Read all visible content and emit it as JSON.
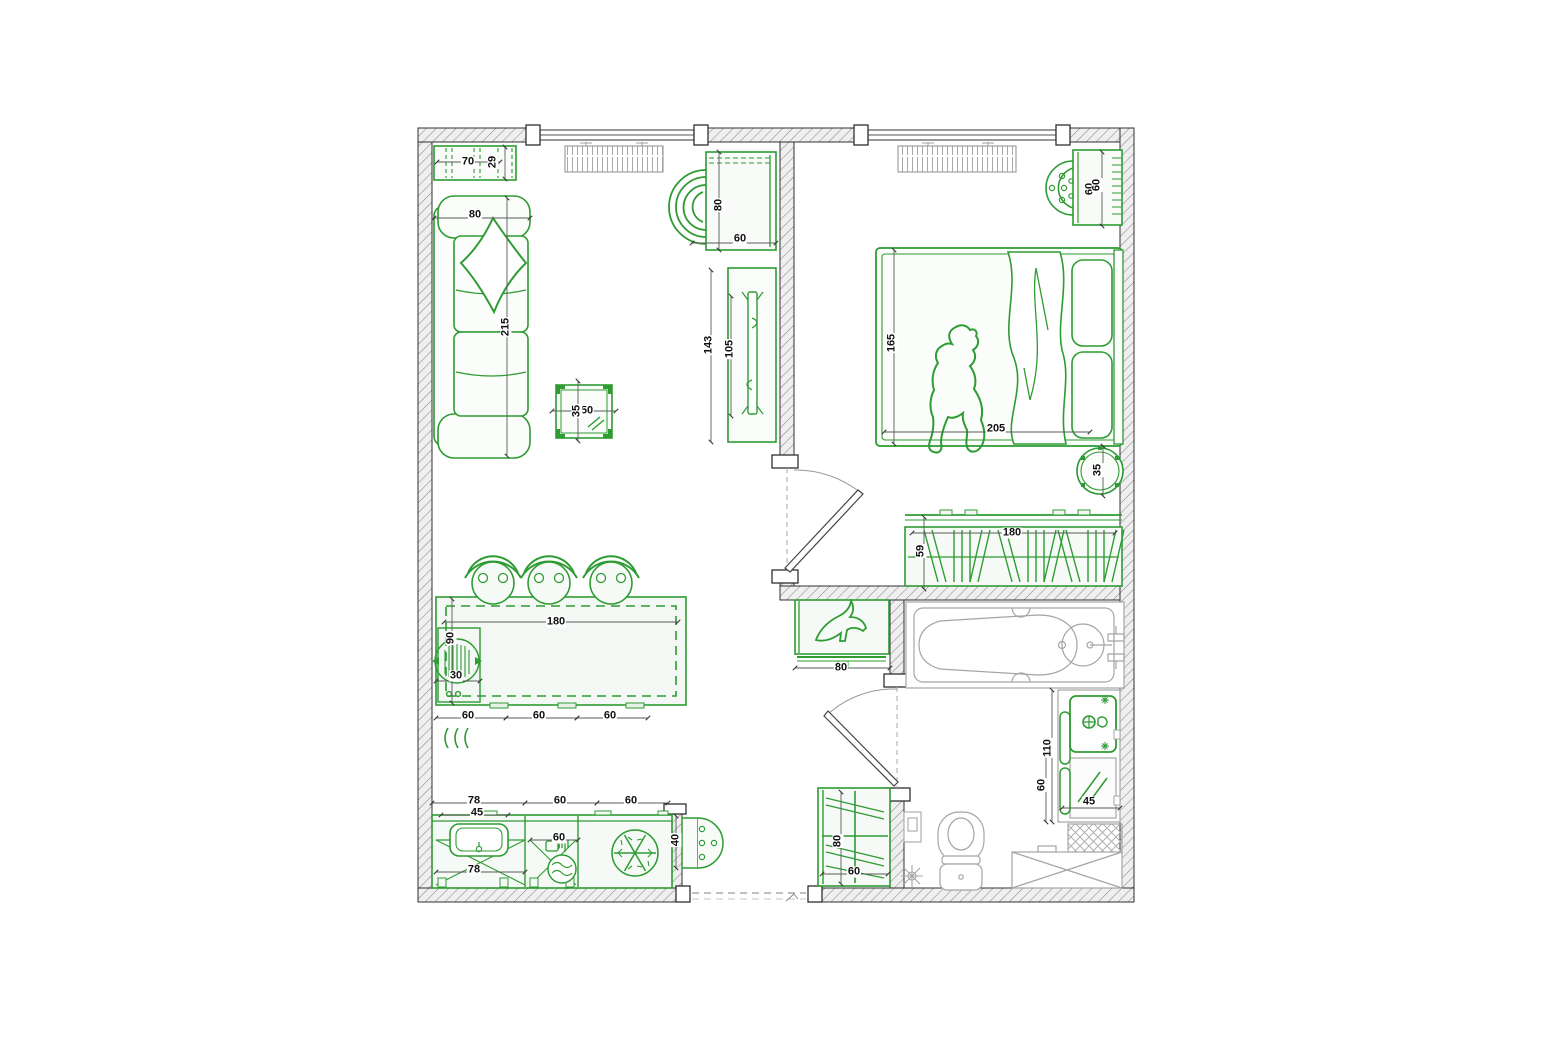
{
  "drawing": {
    "type": "apartment-floor-plan",
    "colors": {
      "furniture_green": "#2e9b33",
      "fixture_gray": "#a5a5a5",
      "wall_hatch_gray": "#8a8a8a",
      "dim_text": "#111111",
      "background": "#ffffff"
    },
    "symbols": {
      "refrigerator": "snowflake-icon",
      "washing_machine": "waves-icon",
      "shoe_cabinet": "high-heel-icon",
      "wardrobe": "hanging-clothes-icon",
      "radiator": "comb-icon",
      "heating_coil": "triple-arc-icon"
    }
  },
  "dims": {
    "c70": "70",
    "c29": "29",
    "s80": "80",
    "s215": "215",
    "t50": "50",
    "t35": "35",
    "a80": "80",
    "a60": "60",
    "tv143": "143",
    "tv105": "105",
    "i180": "180",
    "i90": "90",
    "i30": "30",
    "st60a": "60",
    "st60b": "60",
    "st60c": "60",
    "k78": "78",
    "k60a": "60",
    "k60b": "60",
    "k45": "45",
    "k60in": "60",
    "k78in": "78",
    "e40": "40",
    "sh80": "80",
    "cl80": "80",
    "cl60": "60",
    "b165": "165",
    "b205": "205",
    "d60a": "60",
    "d60b": "60",
    "rs35": "35",
    "w180": "180",
    "w59": "59",
    "v110": "110",
    "v60": "60",
    "v45": "45"
  }
}
